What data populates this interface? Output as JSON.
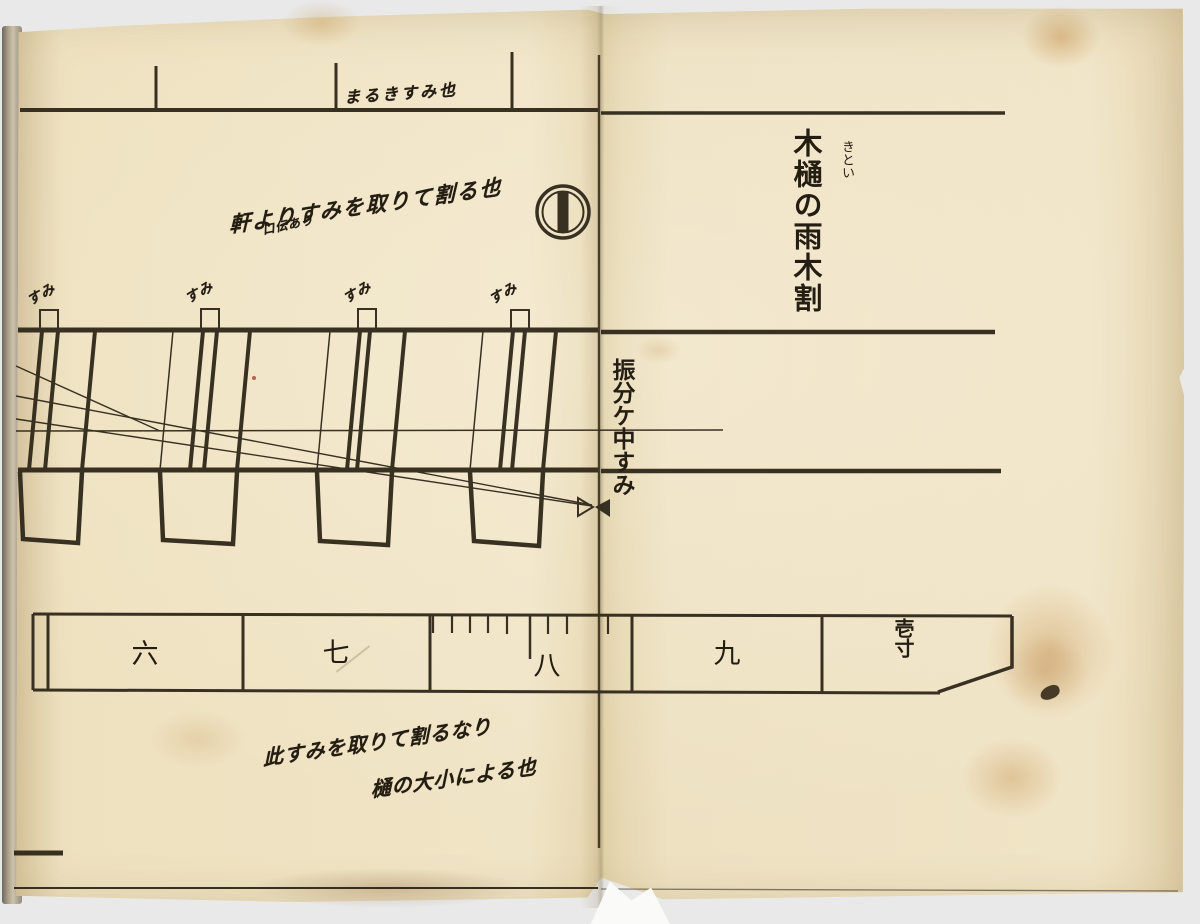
{
  "title": {
    "main": "木樋の雨木割",
    "furigana": "きとい"
  },
  "fold": {
    "label": "振分ケ中すみ"
  },
  "scale": {
    "labels": [
      "六",
      "七",
      "八",
      "九",
      "壱寸"
    ]
  },
  "diagram": {
    "tab_labels": [
      "すみ",
      "すみ",
      "すみ",
      "すみ"
    ]
  },
  "annotations": {
    "top_left_main": "軒よりすみを取りて割る也",
    "top_left_small": "口伝あり",
    "top_edge": "まるきすみ也",
    "bottom_line1": "此すみを取りて割るなり",
    "bottom_line2": "樋の大小による也"
  },
  "symbols": {
    "circle_bar_mark": "circle-with-vertical-bar",
    "bowtie_mark": "center-line-bowtie"
  },
  "colors": {
    "paper": "#efe2c4",
    "ink": "#2b2416",
    "stain": "#c89a50",
    "background": "#ebebeb"
  }
}
